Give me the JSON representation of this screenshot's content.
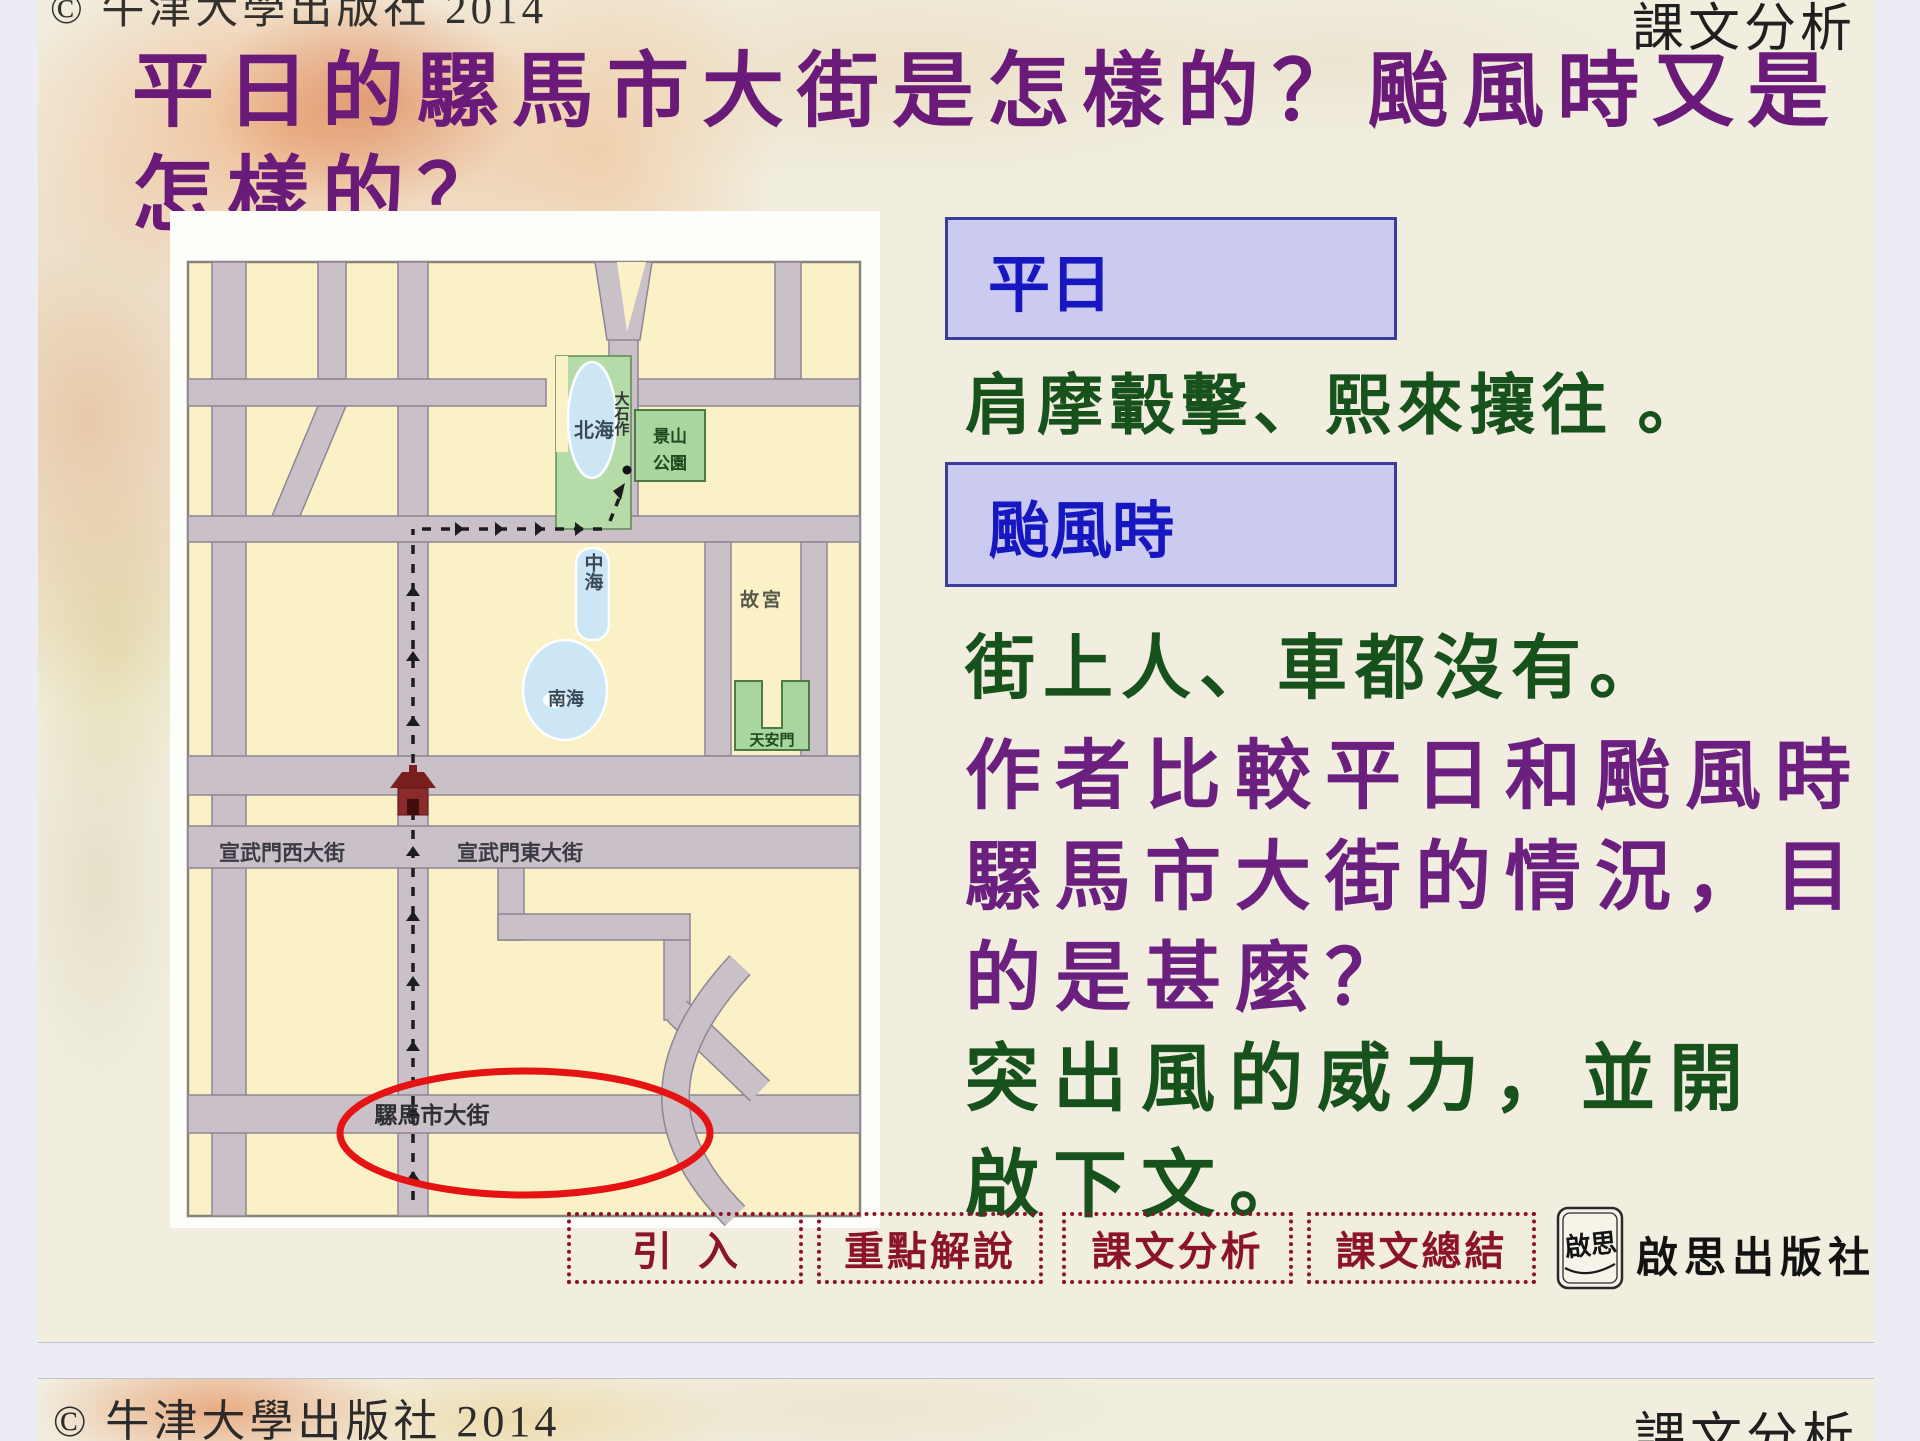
{
  "slide": {
    "header_label": "課文分析",
    "copyright_top": "© 牛津大學出版社 2014",
    "title_line1": "平日的騾馬市大街是怎樣的？颱風時又是",
    "title_line2": "怎樣的？"
  },
  "content": {
    "box1_label": "平日",
    "box1_text": "肩摩轂擊、熙來攘往 。",
    "box2_label": "颱風時",
    "box2_text": "街上人、車都沒有。",
    "question_line1": "作者比較平日和颱風時",
    "question_line2": "騾馬市大街的情況，目",
    "question_line3": "的是甚麼？",
    "answer_line1": "突出風的威力，並開",
    "answer_line2": "啟下文。"
  },
  "map": {
    "labels": {
      "beihai": "北海",
      "zhonghai": "中海",
      "nanhai": "南海",
      "dashizuo": "大石作",
      "jingshan_line1": "景山",
      "jingshan_line2": "公園",
      "gugong": "故宮",
      "tiananmen": "天安門",
      "xuanwumen_west": "宣武門西大街",
      "xuanwumen_east": "宣武門東大街",
      "luomashi": "騾馬市大街"
    }
  },
  "nav": {
    "buttons": [
      "引入",
      "重點解說",
      "課文分析",
      "課文總結"
    ]
  },
  "publisher": {
    "logo_text": "啟思",
    "name": "啟思出版社"
  },
  "next_slide": {
    "copyright": "© 牛津大學出版社 2014",
    "header_label": "課文分析"
  },
  "colors": {
    "title_purple": "#6A1B79",
    "answer_green": "#17511C",
    "box_text_blue": "#1717C2",
    "box_fill": "#CBCBF1",
    "nav_red": "#8C1428",
    "circle_red": "#E51313",
    "app_background": "#ECECF4"
  }
}
